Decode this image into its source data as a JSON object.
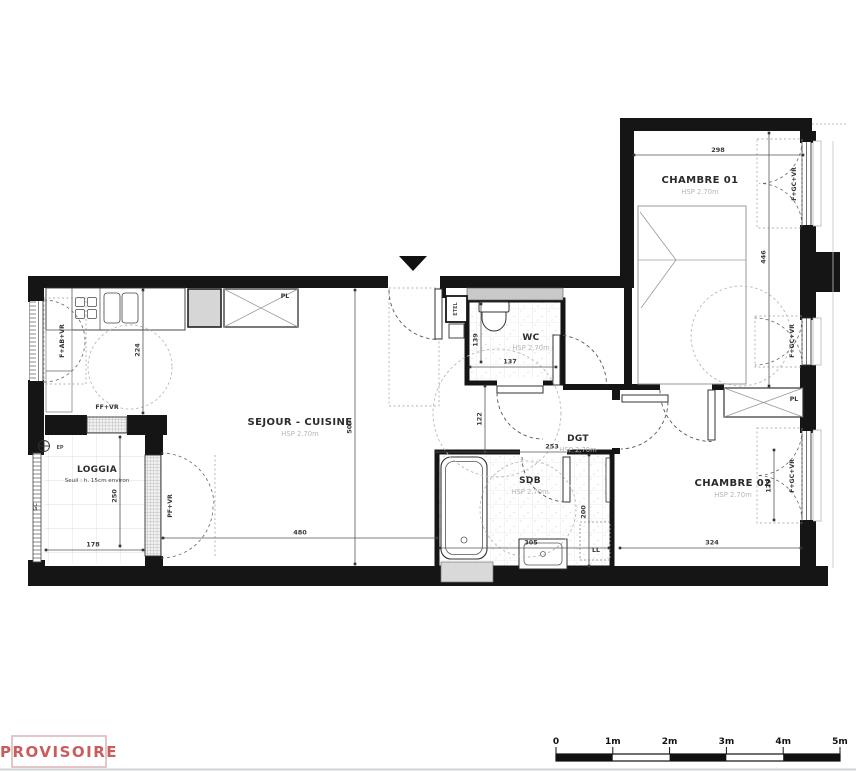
{
  "colors": {
    "wall": "#151515",
    "stamp": "#c95c5c",
    "stamp_border": "#dcb9b9",
    "hsp_gray": "#b5b5b5",
    "dim_text": "#3a3a3a"
  },
  "rooms": {
    "sejour": {
      "label": "SEJOUR - CUISINE",
      "hsp": "HSP 2.70m"
    },
    "loggia": {
      "label": "LOGGIA",
      "note": "Seuil : h. 15cm environ"
    },
    "wc": {
      "label": "WC",
      "hsp": "HSP 2.70m"
    },
    "dgt": {
      "label": "DGT",
      "hsp": "HSP 2.70m"
    },
    "sdb": {
      "label": "SDB",
      "hsp": "HSP 2.70m"
    },
    "chambre1": {
      "label": "CHAMBRE 01",
      "hsp": "HSP 2.70m"
    },
    "chambre2": {
      "label": "CHAMBRE 02",
      "hsp": "HSP 2.70m"
    }
  },
  "dims": {
    "d298": "298",
    "d446": "446",
    "d224": "224",
    "d507": "507",
    "d480": "480",
    "d178": "178",
    "d250": "250",
    "d137": "137",
    "d139": "139",
    "d122": "122",
    "d253": "253",
    "d305": "305",
    "d200": "200",
    "d324": "324",
    "d129": "129"
  },
  "annotations": {
    "pl": "PL",
    "etel": "ETEL",
    "ep": "EP",
    "ll": "LL",
    "gc": "GC",
    "f_ab_vr": "F+AB+VR",
    "ff_vr": "FF+VR",
    "pf_vr": "PF+VR",
    "f_gc_vr": "F+GC+VR"
  },
  "stamp": {
    "label": "PROVISOIRE"
  },
  "scalebar": {
    "ticks": [
      "0",
      "1m",
      "2m",
      "3m",
      "4m",
      "5m"
    ]
  }
}
